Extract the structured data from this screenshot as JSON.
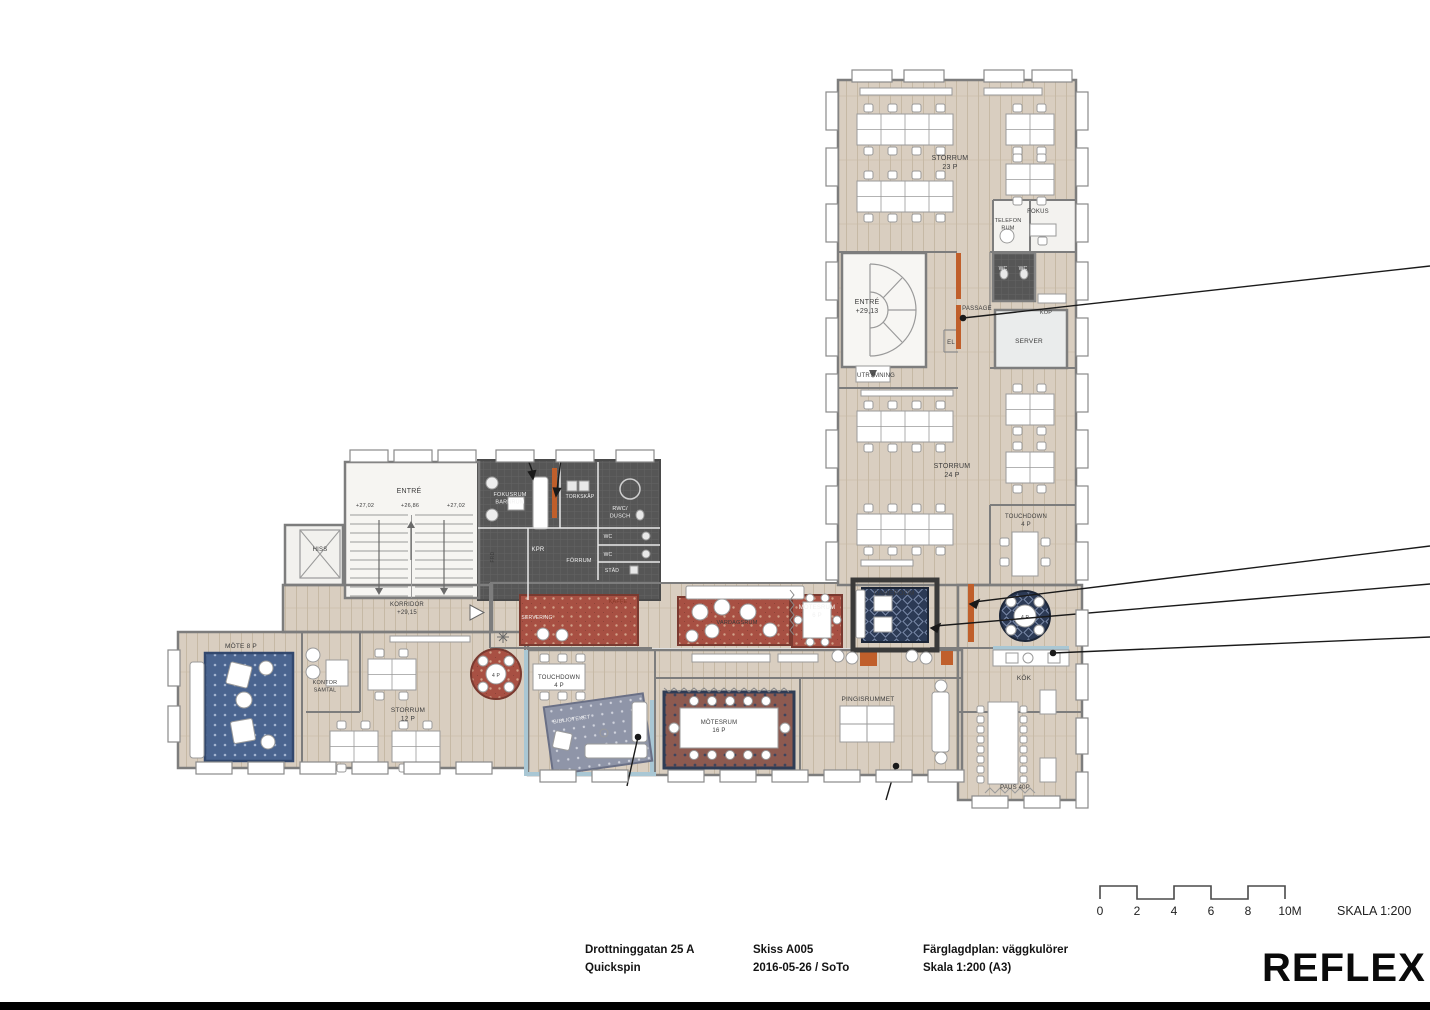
{
  "colors": {
    "floor": "#d9cec0",
    "floor_line": "#c6b9a5",
    "wall": "#7d7d7d",
    "dark": "#565656",
    "orange": "#c05f2b",
    "blue": "#a9c7d4",
    "rug_red": "#a85043",
    "rug_navy": "#2c3a55",
    "rug_blue": "#4a648f",
    "rug_gray": "#8f95a8",
    "rug_meet": "#8d5a50",
    "line": "#1a1a1a"
  },
  "plan": {
    "labels": {
      "storrum23": "STORRUM\n23 P",
      "fokus": "FOKUS",
      "telefonrum": "TELEFON\nRUM",
      "entre_right": "ENTRÉ\n+29,13",
      "passage": "PASSAGE",
      "wc_a": "WC",
      "wc_b": "WC",
      "kop": "KOP",
      "server": "SERVER",
      "el": "EL",
      "utrymning": "UTRYMNING",
      "storrum24": "STORRUM\n24 P",
      "touchdown_r": "TOUCHDOWN\n4 P",
      "gameroom": "GAMEROOM",
      "motesrum6": "MÖTESRUM\n6 P",
      "vardagsrum": "VARDAGSRUM",
      "kaffe": "KAFFE",
      "servering": "SERVERING",
      "entre_left": "ENTRÉ",
      "lvl_a": "+27,02",
      "lvl_b": "+26,86",
      "lvl_c": "+27,02",
      "fokusrum_barnrum": "FOKUSRUM\nBARNRUM",
      "torkskap": "TORKSKÅP",
      "rwc_dusch": "RWC/\nDUSCH",
      "kpr": "KPR",
      "forrum": "FÖRRUM",
      "wc_c": "WC",
      "wc_d": "WC",
      "stad": "STÄD",
      "frd": "FRD",
      "hiss": "HISS",
      "korridor": "KORRIDOR\n+29,15",
      "mote8": "MÖTE 8 P",
      "kontor_samtal": "KONTOR\nSAMTAL",
      "storrum12": "STORRUM\n12 P",
      "touchdown_l": "TOUCHDOWN\n4 P",
      "biblioteket": "BIBLIOTEKET",
      "motesrum16": "MÖTESRUM\n16 P",
      "pingisrummet": "PINGISRUMMET",
      "kok": "KÖK",
      "paus": "PAUS 40P",
      "table4p_r": "4 P",
      "table4p_l": "4 P"
    }
  },
  "scale_bar": {
    "ticks": [
      "0",
      "2",
      "4",
      "6",
      "8",
      "10M"
    ],
    "label": "SKALA 1:200"
  },
  "title_block": {
    "address": "Drottninggatan 25 A",
    "client": "Quickspin",
    "sketch": "Skiss A005",
    "date_author": "2016-05-26 / SoTo",
    "plan_type": "Färglagdplan: väggkulörer",
    "scale": "Skala 1:200 (A3)",
    "logo": "REFLEX"
  }
}
